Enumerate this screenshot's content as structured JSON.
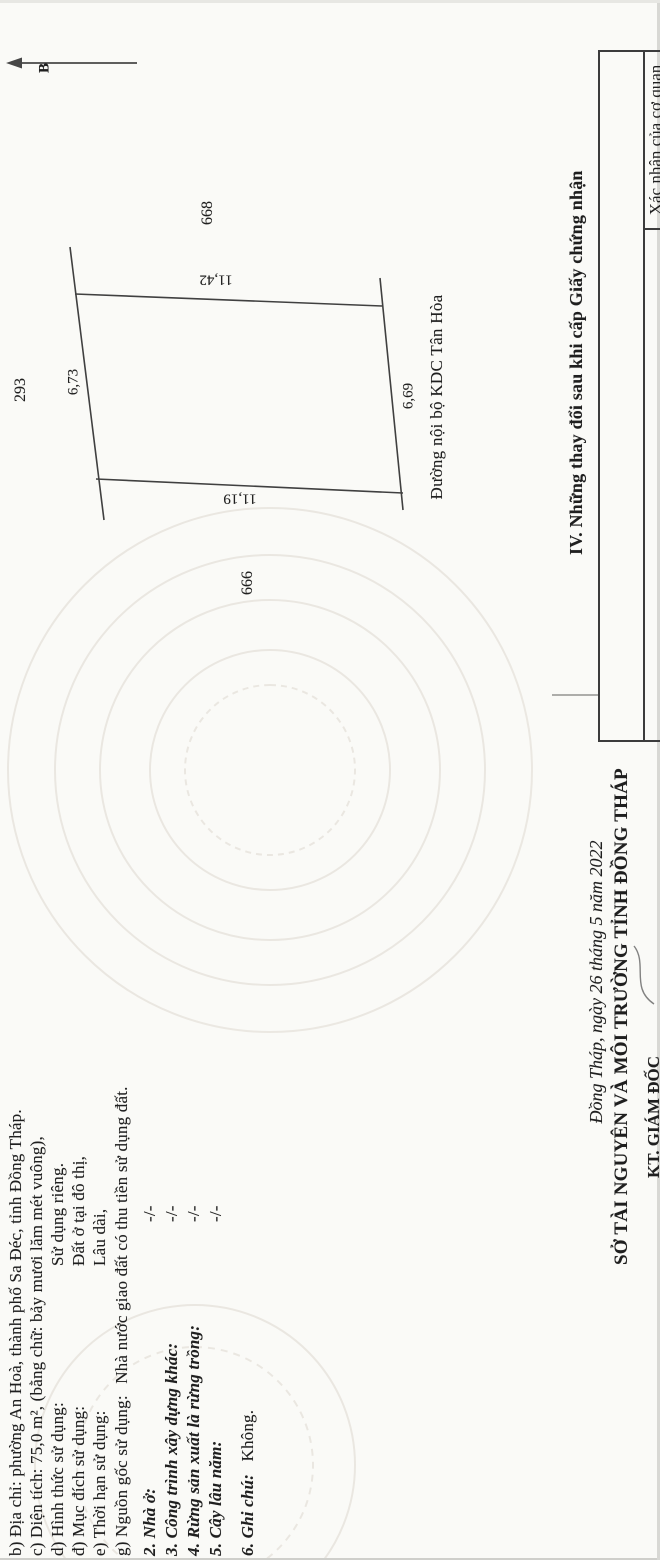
{
  "document": {
    "kind": "Scanned Vietnamese land-use-right certificate page (Giấy chứng nhận quyền sử dụng đất), rotated scan",
    "compass_label": "B",
    "info": {
      "line_b": "b) Địa chỉ: phường An Hoà, thành phố Sa Đéc, tỉnh Đồng Tháp.",
      "line_c": "c) Diện tích: 75,0 m², (bằng chữ: bảy mươi lăm mét vuông),",
      "line_d_label": "d) Hình thức sử dụng:",
      "line_d_value": "Sử dụng riêng.",
      "line_dd_label": "đ) Mục đích sử dụng:",
      "line_dd_value": "Đất ở tại đô thị,",
      "line_e_label": "e) Thời hạn sử dụng:",
      "line_e_value": "Lâu dài,",
      "line_g_label": "g) Nguồn gốc sử dụng:",
      "line_g_value": "Nhà nước giao đất có thu tiền sử dụng đất.",
      "item_2_label": "2. Nhà ở:",
      "item_2_value": "-/-",
      "item_3_label": "3. Công trình xây dựng khác:",
      "item_3_value": "-/-",
      "item_4_label": "4. Rừng sản xuất là rừng trồng:",
      "item_4_value": "-/-",
      "item_5_label": "5. Cây lâu năm:",
      "item_5_value": "-/-",
      "item_6_label": "6. Ghi chú:",
      "item_6_value": "Không."
    },
    "map": {
      "parcel_top": "293",
      "parcel_right": "668",
      "parcel_left": "666",
      "edge_right_length": "11,42",
      "edge_left_length": "11,19",
      "edge_top_length": "6,73",
      "edge_bottom_length": "6,69",
      "road_label": "Đường nội bộ KDC Tân Hòa"
    },
    "section_iv": {
      "title": "IV. Những thay đổi sau khi cấp Giấy chứng nhận",
      "right_column_header": "Xác nhận của cơ quan"
    },
    "signature_block": {
      "date_line": "Đồng Tháp, ngày 26 tháng 5 năm 2022",
      "agency": "SỞ TÀI NGUYÊN VÀ MÔI TRƯỜNG TỈNH ĐỒNG THÁP",
      "signer_title": "KT. GIÁM ĐỐC"
    },
    "ink_color": "#1f1f1f",
    "paper_color": "#fafaf7",
    "watermark_color": "#e9e5df"
  }
}
